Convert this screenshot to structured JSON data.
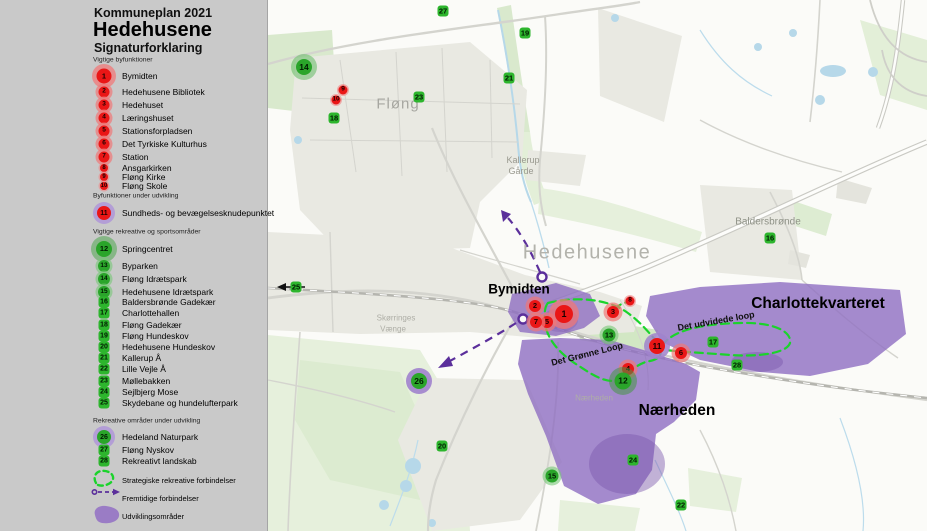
{
  "legend": {
    "plan_title": "Kommuneplan 2021",
    "city_title": "Hedehusene",
    "subtitle": "Signaturforklaring",
    "sections": [
      {
        "header": "Vigtige byfunktioner",
        "items": [
          {
            "n": "1",
            "label": "Bymidten",
            "t": "red-xl"
          },
          {
            "n": "2",
            "label": "Hedehusene Bibliotek",
            "t": "red"
          },
          {
            "n": "3",
            "label": "Hedehuset",
            "t": "red"
          },
          {
            "n": "4",
            "label": "Læringshuset",
            "t": "red"
          },
          {
            "n": "5",
            "label": "Stationsforpladsen",
            "t": "red"
          },
          {
            "n": "6",
            "label": "Det Tyrkiske Kulturhus",
            "t": "red"
          },
          {
            "n": "7",
            "label": "Station",
            "t": "red"
          },
          {
            "n": "8",
            "label": "Ansgarkirken",
            "t": "red-s"
          },
          {
            "n": "9",
            "label": "Fløng Kirke",
            "t": "red-s"
          },
          {
            "n": "10",
            "label": "Fløng Skole",
            "t": "red-s"
          }
        ]
      },
      {
        "header": "Byfunktioner under udvikling",
        "items": [
          {
            "n": "11",
            "label": "Sundheds- og bevægelsesknudepunktet",
            "t": "red-purple"
          }
        ]
      },
      {
        "header": "Vigtige rekreative og sportsområder",
        "items": [
          {
            "n": "12",
            "label": "Springcentret",
            "t": "green-xl"
          },
          {
            "n": "13",
            "label": "Byparken",
            "t": "green"
          },
          {
            "n": "14",
            "label": "Fløng Idrætspark",
            "t": "green"
          },
          {
            "n": "15",
            "label": "Hedehusene Idrætspark",
            "t": "green"
          },
          {
            "n": "16",
            "label": "Baldersbrønde Gadekær",
            "t": "chip"
          },
          {
            "n": "17",
            "label": "Charlottehallen",
            "t": "chip"
          },
          {
            "n": "18",
            "label": "Fløng Gadekær",
            "t": "chip"
          },
          {
            "n": "19",
            "label": "Fløng Hundeskov",
            "t": "chip"
          },
          {
            "n": "20",
            "label": "Hedehusene Hundeskov",
            "t": "chip"
          },
          {
            "n": "21",
            "label": "Kallerup Å",
            "t": "chip"
          },
          {
            "n": "22",
            "label": "Lille Vejle Å",
            "t": "chip"
          },
          {
            "n": "23",
            "label": "Møllebakken",
            "t": "chip"
          },
          {
            "n": "24",
            "label": "Sejlbjerg Mose",
            "t": "chip"
          },
          {
            "n": "25",
            "label": "Skydebane og hundelufterpark",
            "t": "chip"
          }
        ]
      },
      {
        "header": "Rekreative områder under udvikling",
        "items": [
          {
            "n": "26",
            "label": "Hedeland Naturpark",
            "t": "green-purple"
          },
          {
            "n": "27",
            "label": "Fløng Nyskov",
            "t": "chip"
          },
          {
            "n": "28",
            "label": "Rekreativt landskab",
            "t": "chip"
          }
        ]
      }
    ],
    "symbols": [
      {
        "icon": "dash-green",
        "label": "Strategiske rekreative forbindelser"
      },
      {
        "icon": "dash-purple",
        "label": "Fremtidige forbindelser"
      },
      {
        "icon": "area-purple",
        "label": "Udviklingsområder"
      }
    ]
  },
  "map": {
    "markers": [
      {
        "n": "1",
        "x": 564,
        "y": 314,
        "t": "red-xl"
      },
      {
        "n": "2",
        "x": 535,
        "y": 306,
        "t": "red"
      },
      {
        "n": "3",
        "x": 613,
        "y": 312,
        "t": "red"
      },
      {
        "n": "4",
        "x": 628,
        "y": 369,
        "t": "red"
      },
      {
        "n": "5",
        "x": 547,
        "y": 322,
        "t": "red"
      },
      {
        "n": "6",
        "x": 681,
        "y": 353,
        "t": "red"
      },
      {
        "n": "7",
        "x": 536,
        "y": 322,
        "t": "red"
      },
      {
        "n": "8",
        "x": 630,
        "y": 301,
        "t": "red-s"
      },
      {
        "n": "9",
        "x": 343,
        "y": 90,
        "t": "red-s"
      },
      {
        "n": "10",
        "x": 336,
        "y": 100,
        "t": "red-s"
      },
      {
        "n": "11",
        "x": 657,
        "y": 346,
        "t": "red-purple"
      },
      {
        "n": "12",
        "x": 623,
        "y": 381,
        "t": "green-xl"
      },
      {
        "n": "13",
        "x": 609,
        "y": 335,
        "t": "green"
      },
      {
        "n": "14",
        "x": 304,
        "y": 67,
        "t": "green-l"
      },
      {
        "n": "15",
        "x": 552,
        "y": 476,
        "t": "green"
      },
      {
        "n": "16",
        "x": 770,
        "y": 238,
        "t": "chip"
      },
      {
        "n": "17",
        "x": 713,
        "y": 342,
        "t": "chip"
      },
      {
        "n": "18",
        "x": 334,
        "y": 118,
        "t": "chip"
      },
      {
        "n": "19",
        "x": 525,
        "y": 33,
        "t": "chip"
      },
      {
        "n": "20",
        "x": 442,
        "y": 446,
        "t": "chip"
      },
      {
        "n": "21",
        "x": 509,
        "y": 78,
        "t": "chip"
      },
      {
        "n": "22",
        "x": 681,
        "y": 505,
        "t": "chip"
      },
      {
        "n": "23",
        "x": 419,
        "y": 97,
        "t": "chip"
      },
      {
        "n": "24",
        "x": 633,
        "y": 460,
        "t": "chip"
      },
      {
        "n": "25",
        "x": 296,
        "y": 287,
        "t": "chip"
      },
      {
        "n": "26",
        "x": 419,
        "y": 381,
        "t": "green-purple"
      },
      {
        "n": "27",
        "x": 443,
        "y": 11,
        "t": "chip"
      },
      {
        "n": "28",
        "x": 737,
        "y": 365,
        "t": "chip"
      }
    ],
    "labels": [
      {
        "text": "Fløng",
        "x": 398,
        "y": 104,
        "cls": "lbl-town"
      },
      {
        "text": "Kallerup",
        "x": 523,
        "y": 160,
        "cls": "lbl-small"
      },
      {
        "text": "Gårde",
        "x": 521,
        "y": 171,
        "cls": "lbl-small"
      },
      {
        "text": "Hedehusene",
        "x": 587,
        "y": 253,
        "cls": "lbl-city"
      },
      {
        "text": "Baldersbrønde",
        "x": 768,
        "y": 222,
        "cls": "lbl-small2"
      },
      {
        "text": "Skørringes",
        "x": 396,
        "y": 318,
        "cls": "lbl-tiny"
      },
      {
        "text": "Vænge",
        "x": 393,
        "y": 329,
        "cls": "lbl-tiny"
      },
      {
        "text": "Nærheden",
        "x": 594,
        "y": 398,
        "cls": "lbl-tiny"
      },
      {
        "text": "Bymidten",
        "x": 519,
        "y": 289,
        "cls": "lbl-area"
      },
      {
        "text": "Charlottekvarteret",
        "x": 818,
        "y": 304,
        "cls": "lbl-area-lg"
      },
      {
        "text": "Nærheden",
        "x": 677,
        "y": 411,
        "cls": "lbl-area-lg"
      },
      {
        "text": "Det udvidede loop",
        "x": 716,
        "y": 321,
        "cls": "lbl-route",
        "rot": -10
      },
      {
        "text": "Det Grønne Loop",
        "x": 587,
        "y": 354,
        "cls": "lbl-route",
        "rot": -14
      }
    ],
    "colors": {
      "marker_red": "#ea1616",
      "marker_green": "#2db52d",
      "development_purple": "#8f6ec2",
      "strategic_green_dash": "#1bd32b",
      "future_purple_dash": "#5b2f9b",
      "sidebar_gray": "#c9c9c9"
    }
  }
}
